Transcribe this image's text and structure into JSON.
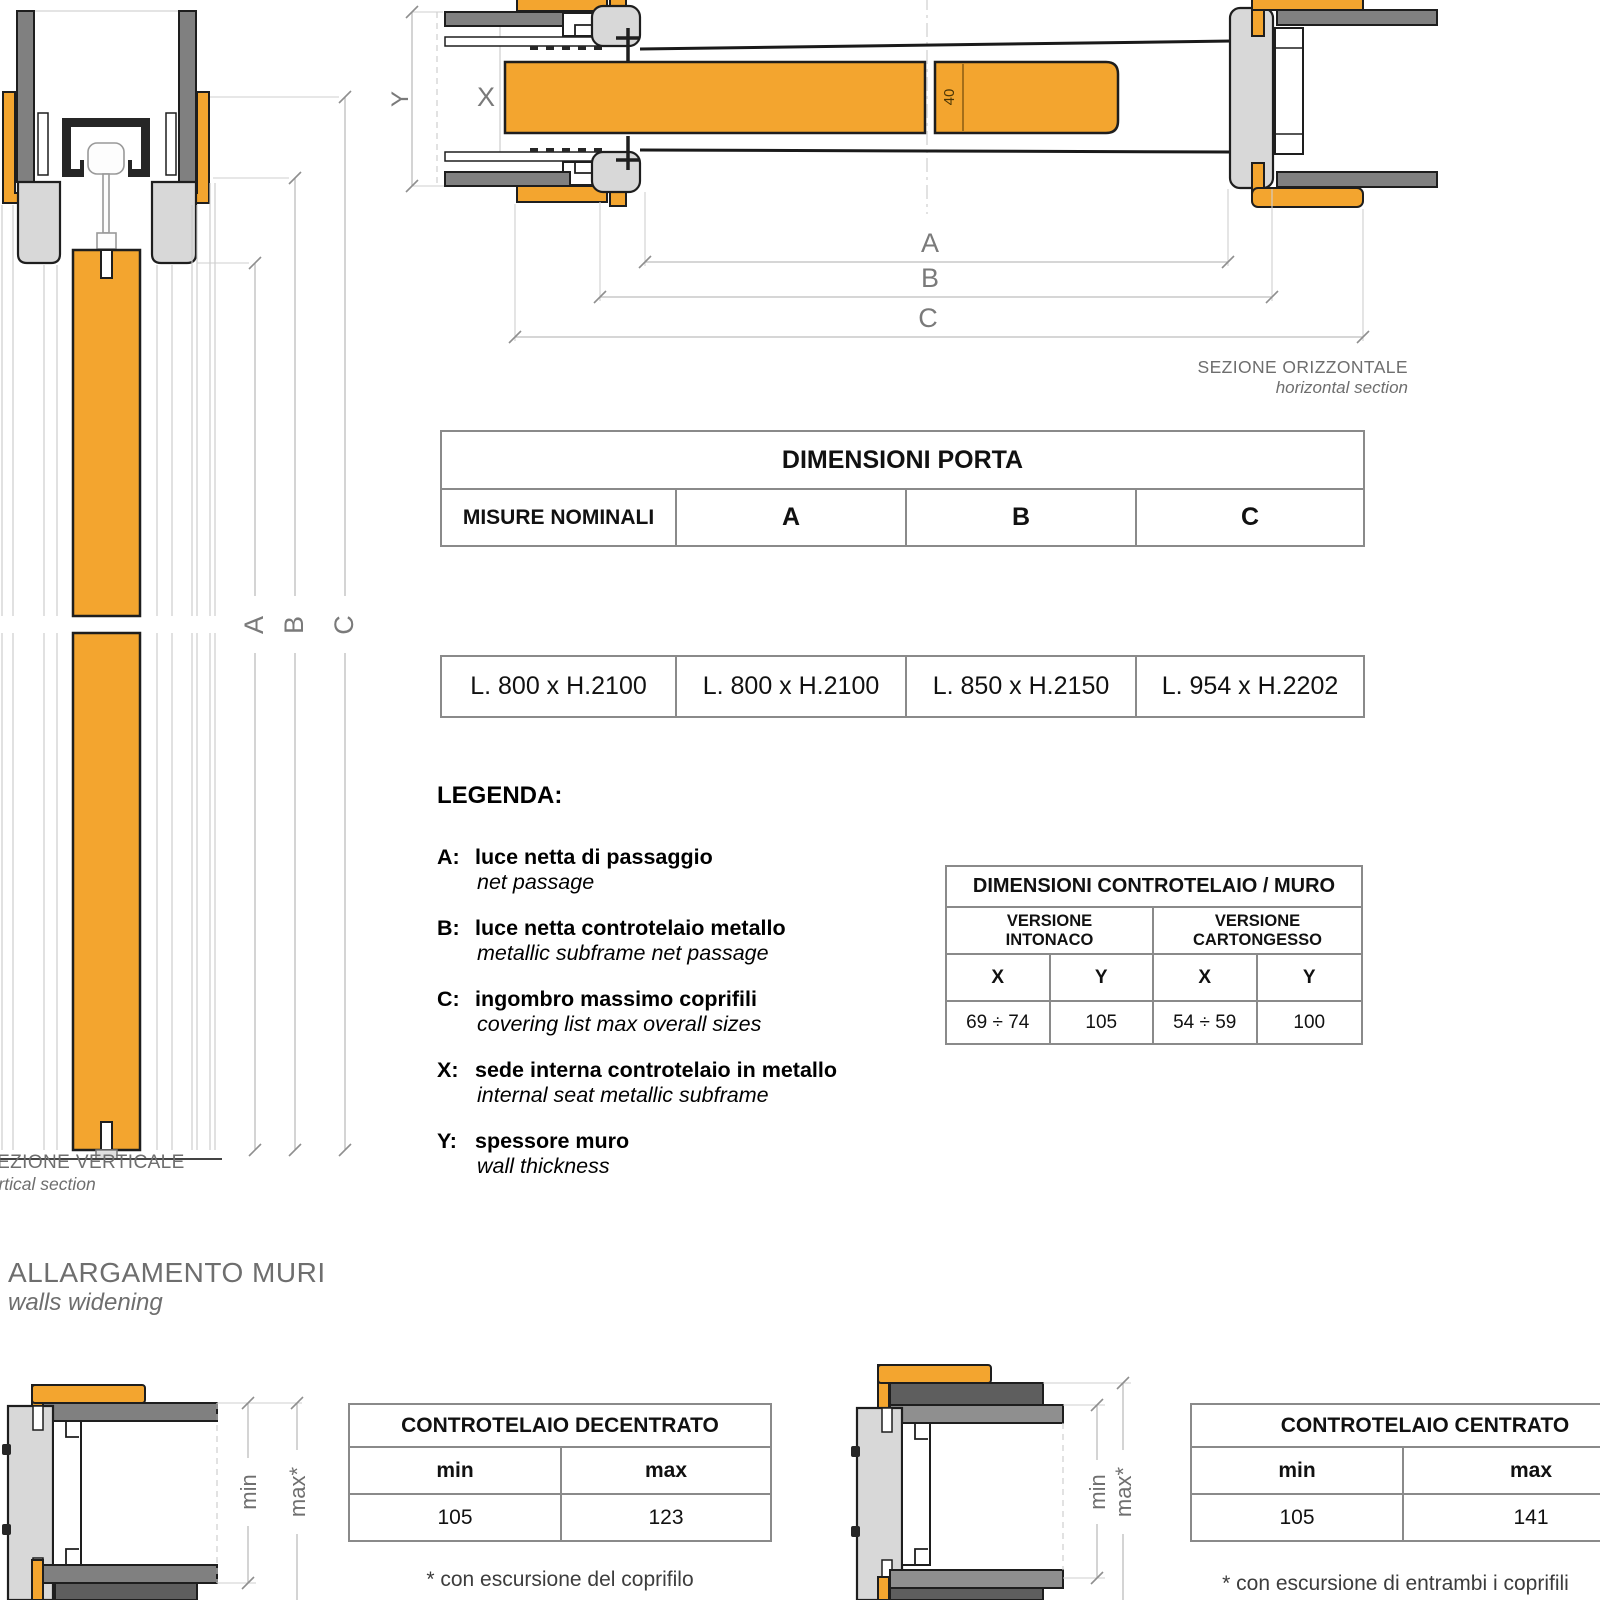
{
  "labels": {
    "a": "A",
    "b": "B",
    "c": "C",
    "x": "X",
    "y": "Y",
    "forty": "40",
    "min": "min",
    "max_star": "max*"
  },
  "captions": {
    "horizontal_title": "SEZIONE ORIZZONTALE",
    "horizontal_sub": "horizontal section",
    "vertical_title": "SEZIONE VERTICALE",
    "vertical_sub": "vertical section",
    "walls_title": "ALLARGAMENTO MURI",
    "walls_sub": "walls widening"
  },
  "porta_table": {
    "title": "DIMENSIONI PORTA",
    "col_headers": [
      "MISURE NOMINALI",
      "A",
      "B",
      "C"
    ],
    "values": [
      "L. 800 x H.2100",
      "L. 800 x H.2100",
      "L. 850 x H.2150",
      "L. 954 x H.2202"
    ]
  },
  "subframe_table": {
    "title": "DIMENSIONI CONTROTELAIO / MURO",
    "version_headers": [
      "VERSIONE\nINTONACO",
      "VERSIONE\nCARTONGESSO"
    ],
    "dim_headers": [
      "X",
      "Y",
      "X",
      "Y"
    ],
    "values": [
      "69 ÷ 74",
      "105",
      "54 ÷ 59",
      "100"
    ]
  },
  "legenda": {
    "title": "LEGENDA:",
    "items": [
      {
        "key": "A:",
        "it": "luce netta di passaggio",
        "en": "net passage"
      },
      {
        "key": "B:",
        "it": "luce netta controtelaio metallo",
        "en": "metallic subframe net passage"
      },
      {
        "key": "C:",
        "it": "ingombro massimo coprifili",
        "en": "covering list max overall sizes"
      },
      {
        "key": "X:",
        "it": "sede interna controtelaio in metallo",
        "en": "internal seat metallic subframe"
      },
      {
        "key": "Y:",
        "it": "spessore muro",
        "en": "wall thickness"
      }
    ]
  },
  "decentrato": {
    "title": "CONTROTELAIO DECENTRATO",
    "min_label": "min",
    "max_label": "max",
    "min": "105",
    "max": "123",
    "footnote": "* con escursione del coprifilo"
  },
  "centrato": {
    "title": "CONTROTELAIO CENTRATO",
    "min_label": "min",
    "max_label": "max",
    "min": "105",
    "max": "141",
    "footnote": "* con escursione di entrambi i  coprifili"
  },
  "colors": {
    "orange": "#F3A52F",
    "wall_gray": "#808080",
    "profile_light_gray": "#D8D8D8",
    "plate_dark_gray": "#5E5E5E",
    "plate_mid_gray": "#8F8F8F",
    "track_black": "#262626",
    "dimension_gray": "#BDBDBD",
    "caption_gray": "#6E6E6E"
  }
}
